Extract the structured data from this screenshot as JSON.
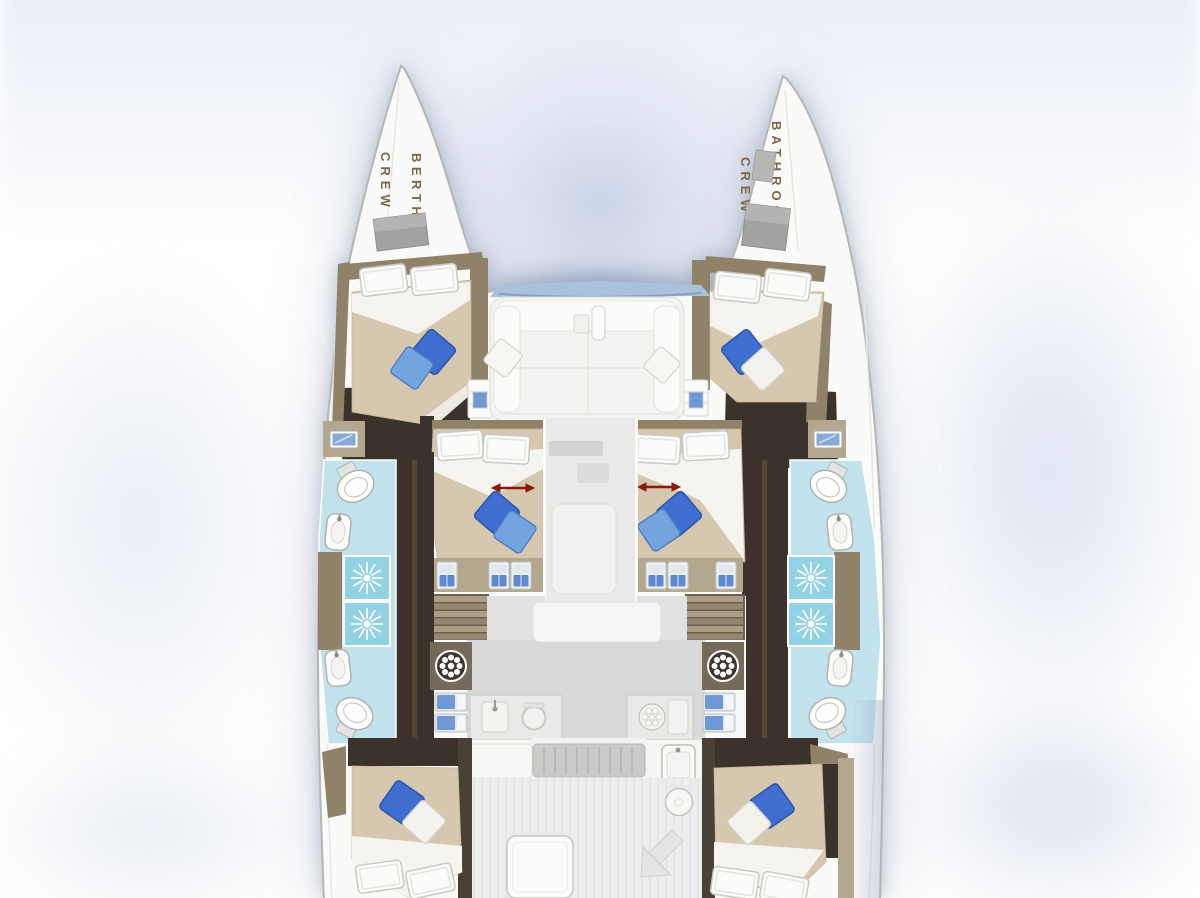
{
  "diagram_type": "catamaran-yacht-deck-plan",
  "labels": {
    "port_bow_line1": "CREW",
    "port_bow_line2": "BERTH",
    "starboard_bow_line1": "CREW",
    "starboard_bow_line2": "BATHROOM"
  },
  "colors": {
    "hull": "#fafaf8",
    "hull_outline": "#b5b7b3",
    "wood": "#8f8269",
    "wood_light": "#b3a78d",
    "cabin_floor": "#3a322b",
    "duvet": "#d5c8ae",
    "linen": "#f6f4ee",
    "pillow_blue": "#3e6fd0",
    "pillow_blue_light": "#74a4de",
    "bath_floor": "#c2e3ed",
    "shower_tile": "#93d2e4",
    "arrow_red": "#8b1a0e",
    "label_text": "#7d6747",
    "saloon_floor": "#d8d9d8",
    "tramp_band": "#a9c2da"
  }
}
